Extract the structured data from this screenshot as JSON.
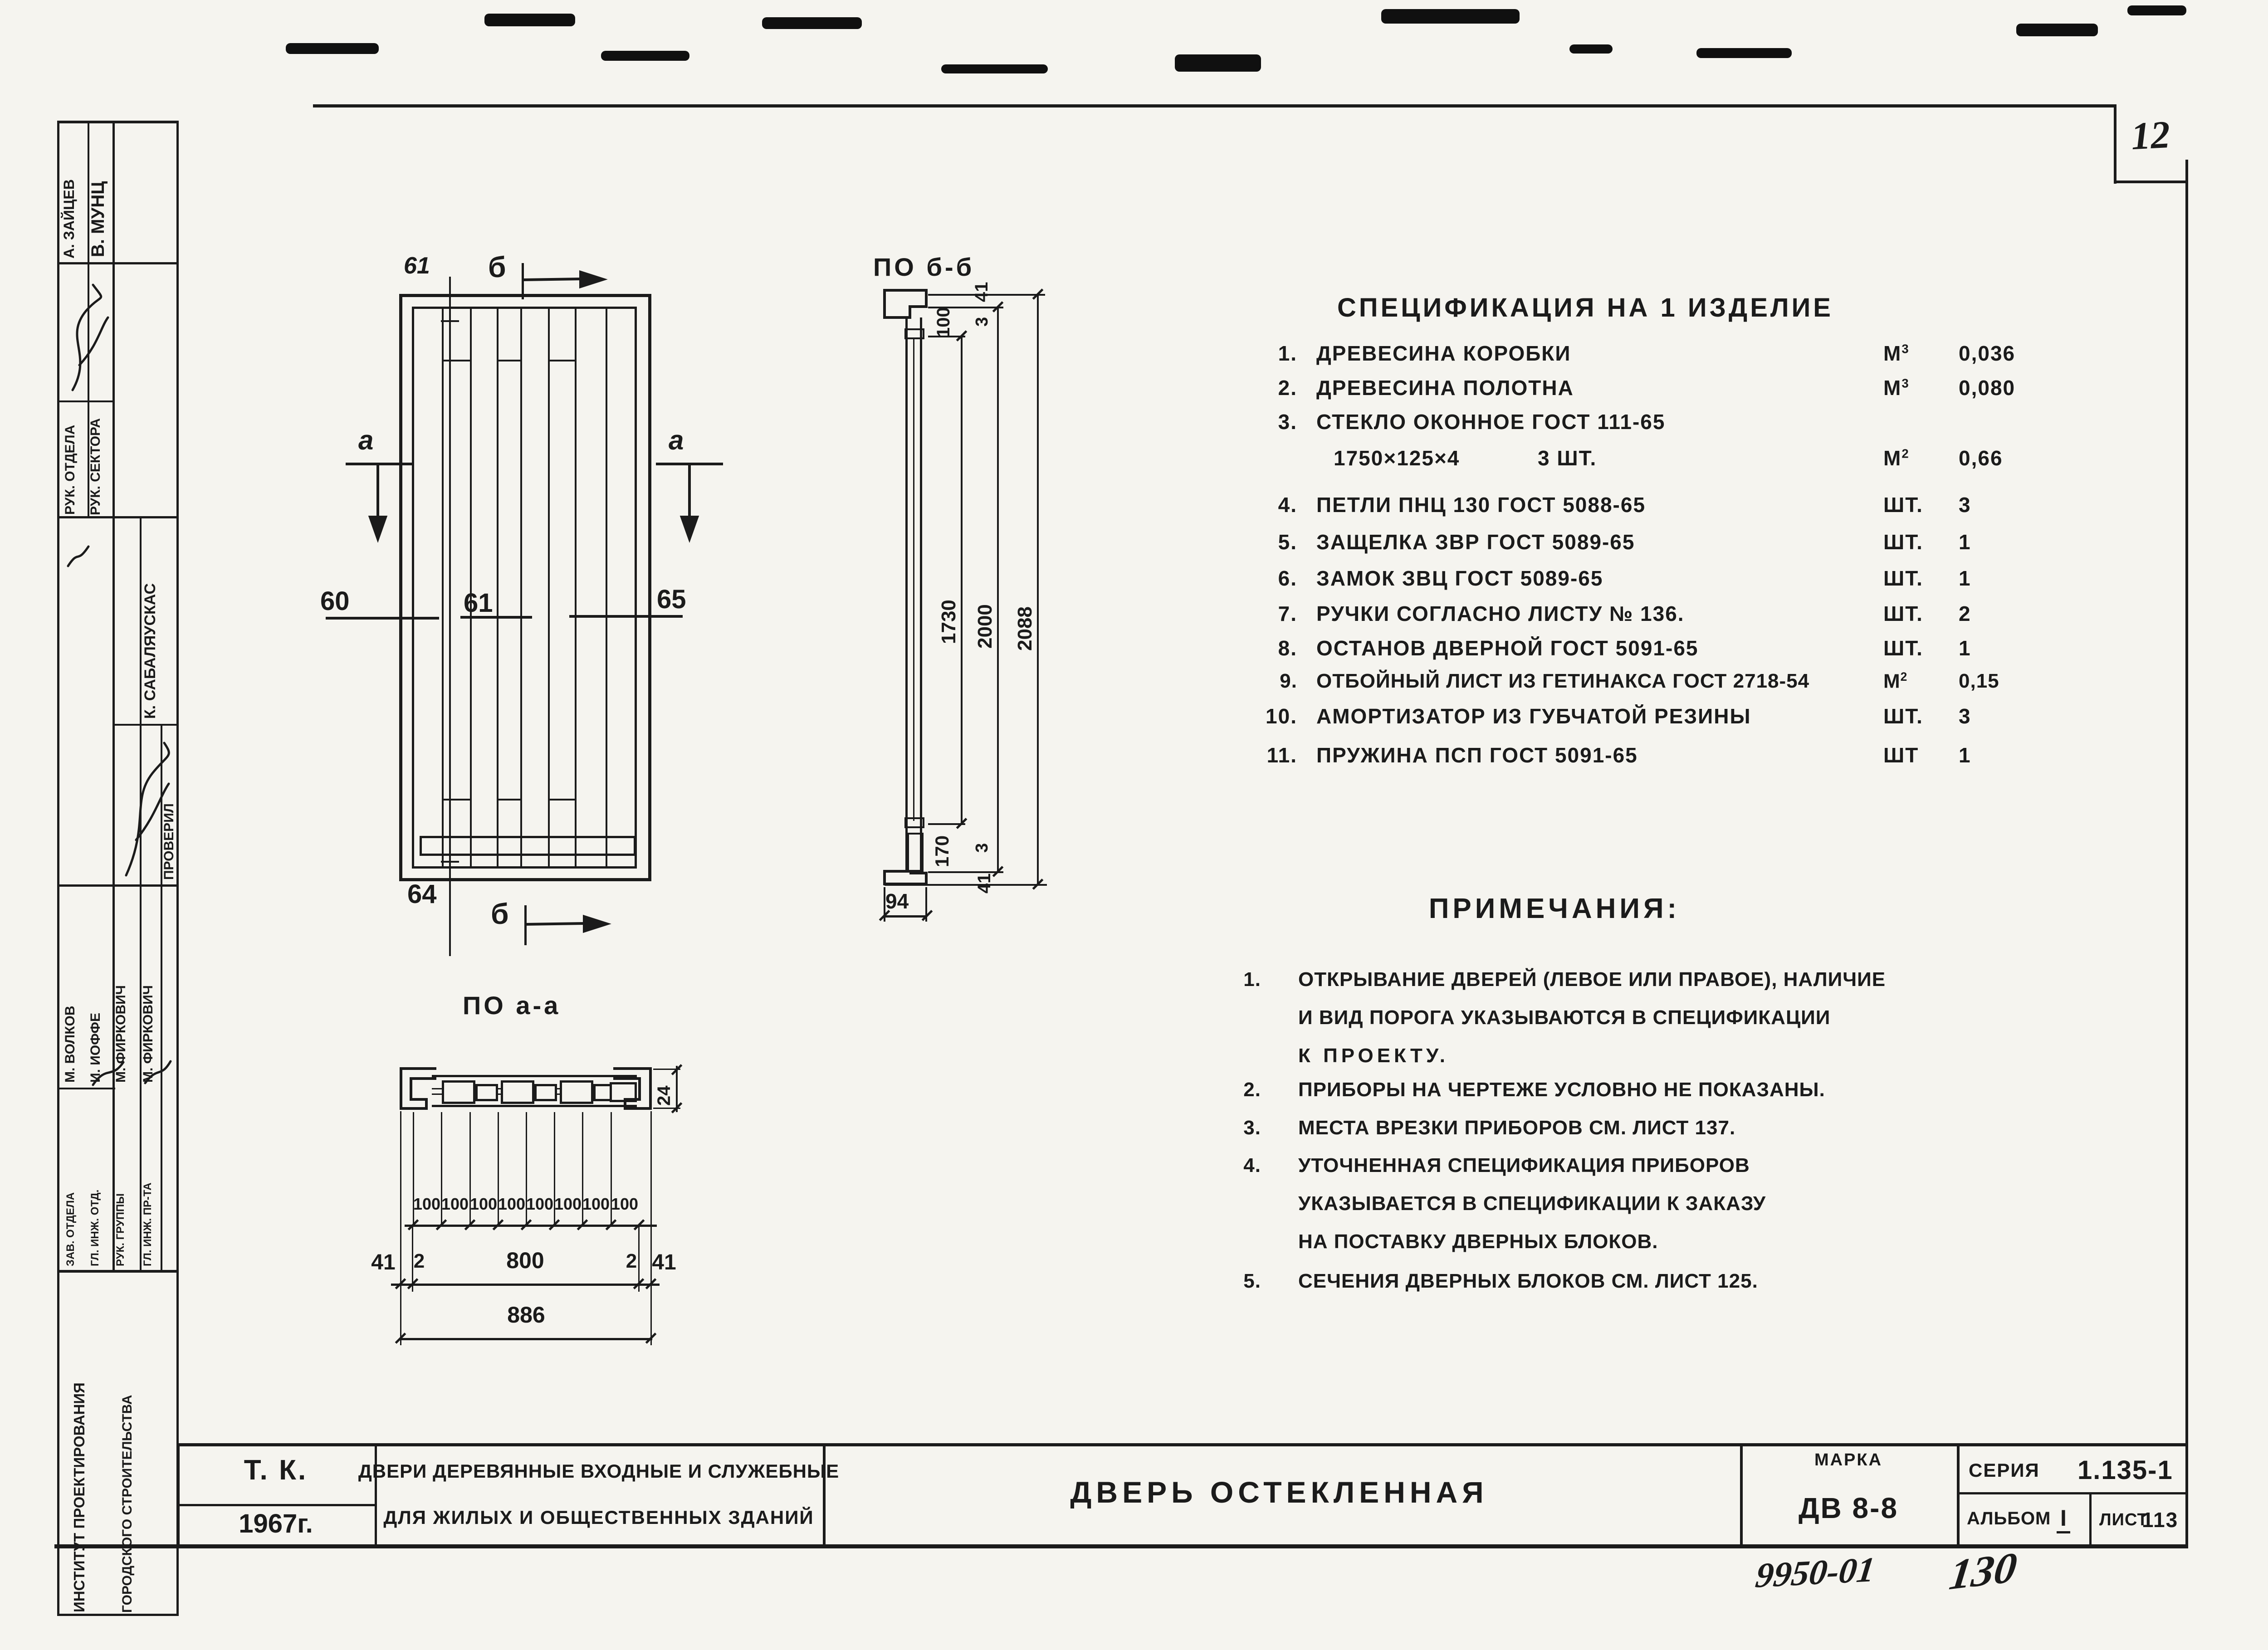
{
  "colors": {
    "paper": "#f5f4ef",
    "ink": "#1b1b1b"
  },
  "page_stamp": "12",
  "sidebar": {
    "institute_line1": "ИНСТИТУТ ПРОЕКТИРОВАНИЯ",
    "institute_line2": "ГОРОДСКОГО СТРОИТЕЛЬСТВА",
    "checked_label": "ПРОВЕРИЛ",
    "top_entries": [
      {
        "role": "РУК. ОТДЕЛА",
        "name": "А. ЗАЙЦЕВ"
      },
      {
        "role": "РУК. СЕКТОРА",
        "name": "В. МУНЦ"
      }
    ],
    "middle_name": "К. САБАЛЯУСКАС",
    "staff": [
      {
        "role": "ЗАВ. ОТДЕЛА",
        "name": "М. ВОЛКОВ"
      },
      {
        "role": "ГЛ. ИНЖ. ОТД.",
        "name": "И. ИОФФЕ"
      },
      {
        "role": "РУК. ГРУППЫ",
        "name": "М. ФИРКОВИЧ"
      },
      {
        "role": "ГЛ. ИНЖ. ПР-ТА",
        "name": "М. ФИРКОВИЧ"
      }
    ]
  },
  "elevation": {
    "detail_top": "61",
    "detail_left": "60",
    "detail_center": "61",
    "detail_right": "65",
    "detail_bottom": "64",
    "section_b": "б",
    "section_a": "а"
  },
  "section_bb": {
    "title": "ПО б-б",
    "dim_41_top": "41",
    "dim_100": "100",
    "dim_3_top": "3",
    "dim_1730": "1730",
    "dim_2000": "2000",
    "dim_2088": "2088",
    "dim_170": "170",
    "dim_3_bottom": "3",
    "dim_41_bottom": "41",
    "dim_94": "94"
  },
  "section_aa": {
    "title": "ПО а-а",
    "dim_100": "100",
    "dim_41": "41",
    "dim_2": "2",
    "dim_800": "800",
    "dim_886": "886",
    "dim_24": "24"
  },
  "specification": {
    "title": "СПЕЦИФИКАЦИЯ НА 1 ИЗДЕЛИЕ",
    "items": [
      {
        "no": "1.",
        "text": "ДРЕВЕСИНА КОРОБКИ",
        "unit": "М",
        "sup": "3",
        "qty": "0,036"
      },
      {
        "no": "2.",
        "text": "ДРЕВЕСИНА ПОЛОТНА",
        "unit": "М",
        "sup": "3",
        "qty": "0,080"
      },
      {
        "no": "3.",
        "text": "СТЕКЛО ОКОННОЕ ГОСТ 111-65",
        "text2": "1750×125×4",
        "text2b": "3 ШТ.",
        "unit": "М",
        "sup": "2",
        "qty": "0,66"
      },
      {
        "no": "4.",
        "text": "ПЕТЛИ ПНЦ 130 ГОСТ 5088-65",
        "unit": "ШТ.",
        "sup": "",
        "qty": "3"
      },
      {
        "no": "5.",
        "text": "ЗАЩЕЛКА ЗВР ГОСТ 5089-65",
        "unit": "ШТ.",
        "sup": "",
        "qty": "1"
      },
      {
        "no": "6.",
        "text": "ЗАМОК ЗВЦ ГОСТ 5089-65",
        "unit": "ШТ.",
        "sup": "",
        "qty": "1"
      },
      {
        "no": "7.",
        "text": "РУЧКИ СОГЛАСНО ЛИСТУ № 136.",
        "unit": "ШТ.",
        "sup": "",
        "qty": "2"
      },
      {
        "no": "8.",
        "text": "ОСТАНОВ ДВЕРНОЙ ГОСТ 5091-65",
        "unit": "ШТ.",
        "sup": "",
        "qty": "1"
      },
      {
        "no": "9.",
        "text": "ОТБОЙНЫЙ ЛИСТ ИЗ ГЕТИНАКСА ГОСТ 2718-54",
        "unit": "М",
        "sup": "2",
        "qty": "0,15"
      },
      {
        "no": "10.",
        "text": "АМОРТИЗАТОР ИЗ ГУБЧАТОЙ РЕЗИНЫ",
        "unit": "ШТ.",
        "sup": "",
        "qty": "3"
      },
      {
        "no": "11.",
        "text": "ПРУЖИНА ПСП ГОСТ 5091-65",
        "unit": "ШТ",
        "sup": "",
        "qty": "1"
      }
    ]
  },
  "notes": {
    "title": "ПРИМЕЧАНИЯ:",
    "items": [
      {
        "no": "1.",
        "line1": "ОТКРЫВАНИЕ ДВЕРЕЙ (ЛЕВОЕ ИЛИ ПРАВОЕ), НАЛИЧИЕ",
        "line2": "И ВИД ПОРОГА УКАЗЫВАЮТСЯ В СПЕЦИФИКАЦИИ",
        "line3": "К ПРОЕКТУ."
      },
      {
        "no": "2.",
        "line1": "ПРИБОРЫ НА ЧЕРТЕЖЕ УСЛОВНО НЕ ПОКАЗАНЫ."
      },
      {
        "no": "3.",
        "line1": "МЕСТА ВРЕЗКИ ПРИБОРОВ СМ. ЛИСТ 137."
      },
      {
        "no": "4.",
        "line1": "УТОЧНЕННАЯ СПЕЦИФИКАЦИЯ ПРИБОРОВ",
        "line2": "УКАЗЫВАЕТСЯ В СПЕЦИФИКАЦИИ К ЗАКАЗУ",
        "line3": "НА ПОСТАВКУ ДВЕРНЫХ БЛОКОВ."
      },
      {
        "no": "5.",
        "line1": "СЕЧЕНИЯ ДВЕРНЫХ БЛОКОВ СМ. ЛИСТ 125."
      }
    ]
  },
  "title_block": {
    "tk": "Т. К.",
    "year": "1967г.",
    "desc_line1": "ДВЕРИ ДЕРЕВЯННЫЕ ВХОДНЫЕ И СЛУЖЕБНЫЕ",
    "desc_line2": "ДЛЯ ЖИЛЫХ И ОБЩЕСТВЕННЫХ ЗДАНИЙ",
    "main_title": "ДВЕРЬ ОСТЕКЛЕННАЯ",
    "marka_label": "МАРКА",
    "marka_value": "ДВ 8-8",
    "series_label": "СЕРИЯ",
    "series_value": "1.135-1",
    "album_label": "АЛЬБОМ",
    "album_value": "I",
    "sheet_label": "ЛИСТ",
    "sheet_value": "113"
  },
  "handwriting": {
    "doc_no": "9950-01",
    "extra": "130"
  }
}
